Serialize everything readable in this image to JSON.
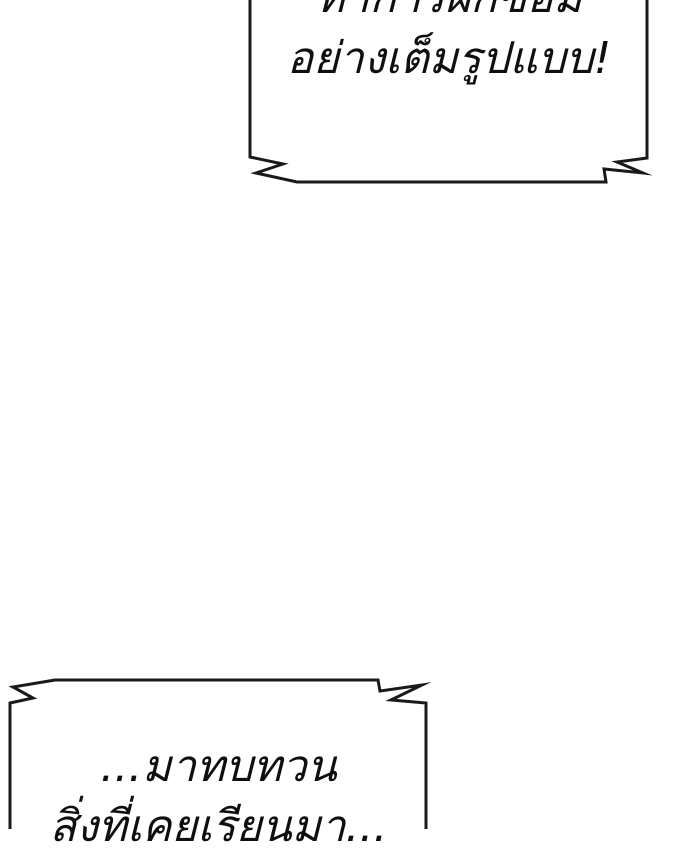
{
  "page": {
    "kind": "comic-panel",
    "background_color": "#ffffff"
  },
  "colors": {
    "outline": "#1a1a1a",
    "text": "#0f0f0f",
    "bubble_fill": "#ffffff"
  },
  "bubbles": {
    "top": {
      "style": "shout-rectangular-burst",
      "clipped_edge": "top",
      "line1": "ทำการฝึกซ้อม",
      "line2": "อย่างเต็มรูปแบบ!"
    },
    "bottom": {
      "style": "shout-rectangular-burst",
      "clipped_edge": "bottom",
      "line1": "...มาทบทวน",
      "line2": "สิ่งที่เคยเรียนมา..."
    }
  }
}
